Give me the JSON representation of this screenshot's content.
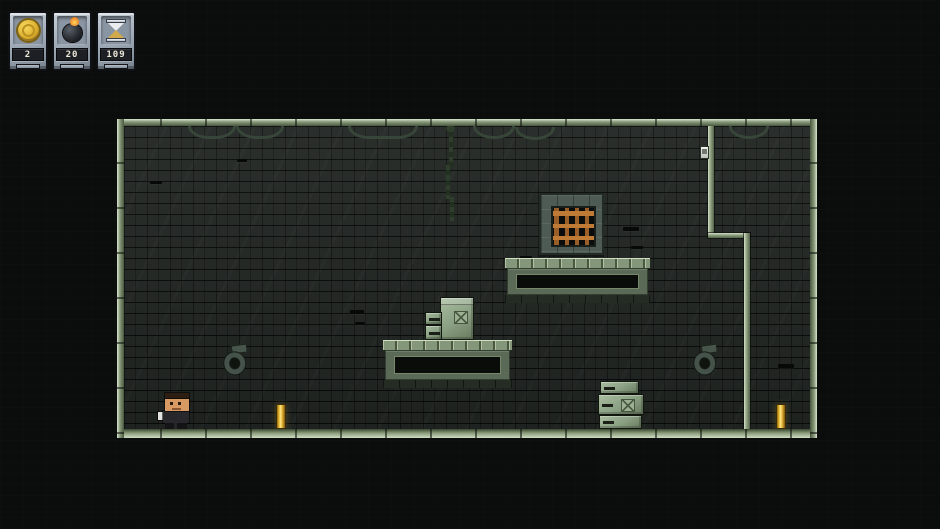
{
  "hud": {
    "stats": [
      {
        "id": "coins",
        "icon": "coin-icon",
        "value": "2"
      },
      {
        "id": "bombs",
        "icon": "bomb-icon",
        "value": "20"
      },
      {
        "id": "timer",
        "icon": "hourglass-icon",
        "value": "109"
      }
    ]
  },
  "scene": {
    "type": "2d-platformer-dungeon-level",
    "entities": [
      "player-character",
      "gold-bar-left",
      "gold-bar-right",
      "crate-stack-on-platform",
      "crate-stack-on-floor",
      "vent-platform-upper",
      "vent-platform-lower",
      "barred-window",
      "wall-ring-left",
      "wall-ring-right",
      "hanging-chains",
      "hanging-vine",
      "wall-lamp",
      "partition-wall"
    ]
  },
  "colors": {
    "background": "#0b0d0c",
    "wall_brick": "#232825",
    "frame_green_light": "#d9e5cf",
    "frame_green_mid": "#8a9c7c",
    "platform_green": "#5a6a57",
    "crate_green": "#8aa082",
    "window_bars_orange": "#bf7a35",
    "gold": "#f0c23a",
    "hud_stone": "#a3aebb",
    "hud_strip_bg": "#1c1f24",
    "hud_digit": "#ece8d8"
  }
}
